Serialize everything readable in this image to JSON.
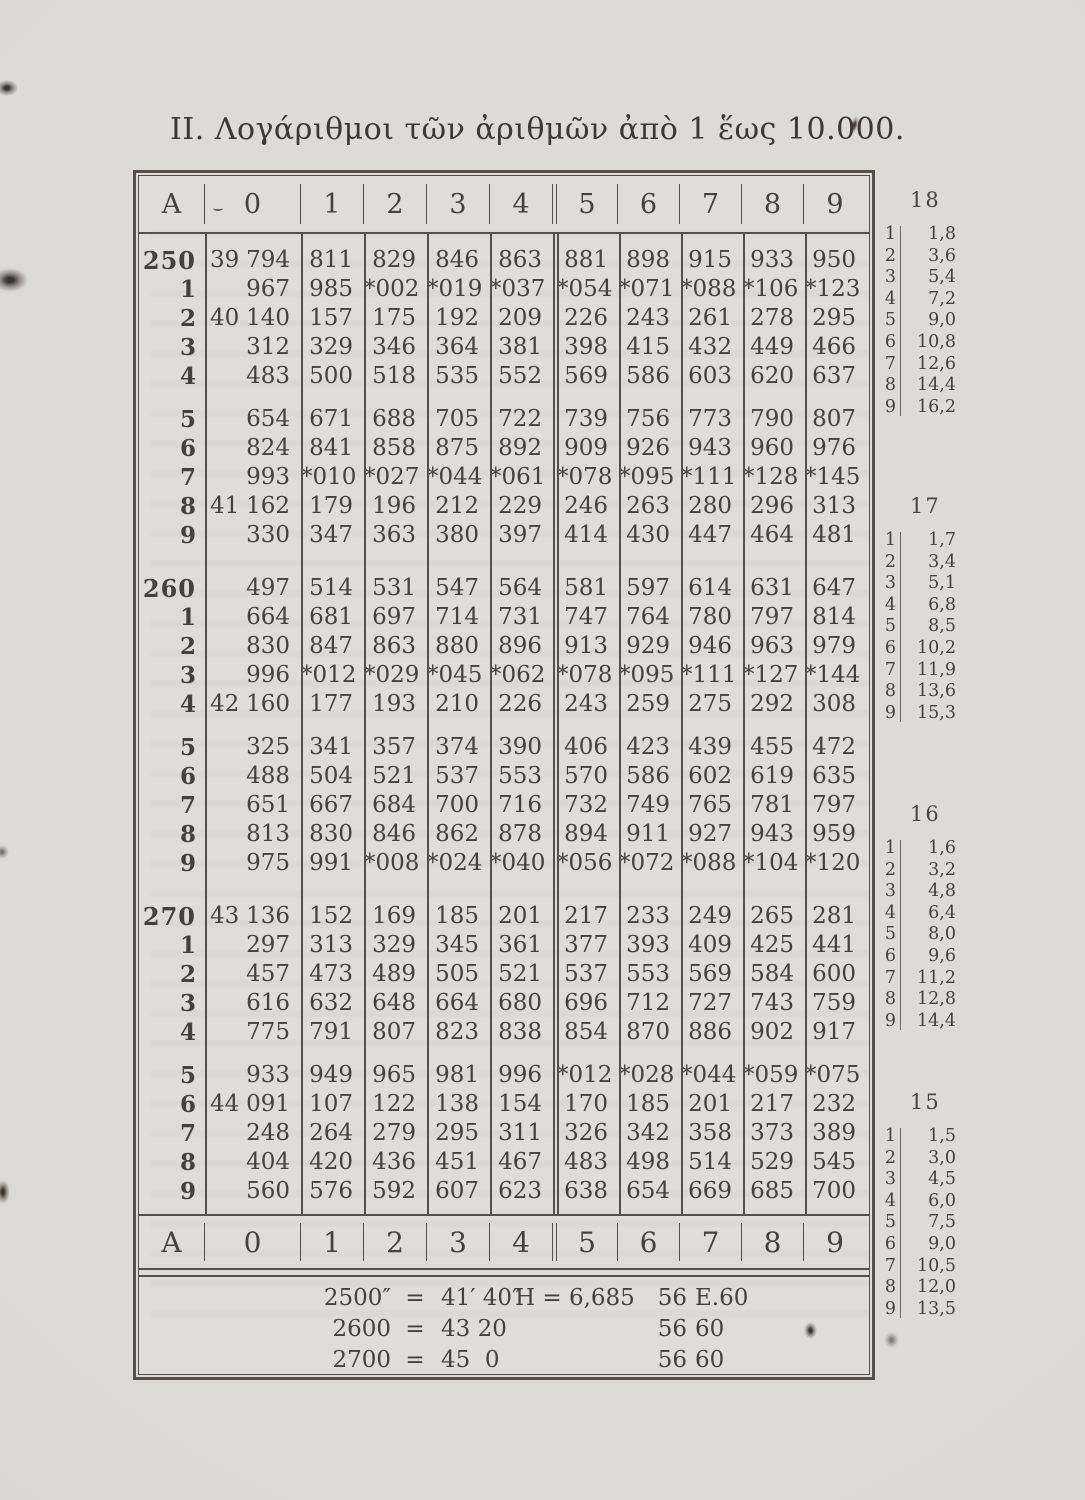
{
  "page": {
    "title": "II. Λογάριθμοι τῶν ἀριθμῶν ἀπὸ 1 ἕως 10.000."
  },
  "main_table": {
    "header": [
      "A",
      "0",
      "1",
      "2",
      "3",
      "4",
      "5",
      "6",
      "7",
      "8",
      "9"
    ],
    "footer_header": [
      "A",
      "0",
      "1",
      "2",
      "3",
      "4",
      "5",
      "6",
      "7",
      "8",
      "9"
    ],
    "blocks": [
      {
        "rows": [
          {
            "a": "250",
            "prefix": "39",
            "cells": [
              "794",
              "811",
              "829",
              "846",
              "863",
              "881",
              "898",
              "915",
              "933",
              "950"
            ]
          },
          {
            "a": "1",
            "prefix": "",
            "cells": [
              "967",
              "985",
              "*002",
              "*019",
              "*037",
              "*054",
              "*071",
              "*088",
              "*106",
              "*123"
            ]
          },
          {
            "a": "2",
            "prefix": "40",
            "cells": [
              "140",
              "157",
              "175",
              "192",
              "209",
              "226",
              "243",
              "261",
              "278",
              "295"
            ]
          },
          {
            "a": "3",
            "prefix": "",
            "cells": [
              "312",
              "329",
              "346",
              "364",
              "381",
              "398",
              "415",
              "432",
              "449",
              "466"
            ]
          },
          {
            "a": "4",
            "prefix": "",
            "cells": [
              "483",
              "500",
              "518",
              "535",
              "552",
              "569",
              "586",
              "603",
              "620",
              "637"
            ]
          },
          {
            "a": "5",
            "prefix": "",
            "cells": [
              "654",
              "671",
              "688",
              "705",
              "722",
              "739",
              "756",
              "773",
              "790",
              "807"
            ]
          },
          {
            "a": "6",
            "prefix": "",
            "cells": [
              "824",
              "841",
              "858",
              "875",
              "892",
              "909",
              "926",
              "943",
              "960",
              "976"
            ]
          },
          {
            "a": "7",
            "prefix": "",
            "cells": [
              "993",
              "*010",
              "*027",
              "*044",
              "*061",
              "*078",
              "*095",
              "*111",
              "*128",
              "*145"
            ]
          },
          {
            "a": "8",
            "prefix": "41",
            "cells": [
              "162",
              "179",
              "196",
              "212",
              "229",
              "246",
              "263",
              "280",
              "296",
              "313"
            ]
          },
          {
            "a": "9",
            "prefix": "",
            "cells": [
              "330",
              "347",
              "363",
              "380",
              "397",
              "414",
              "430",
              "447",
              "464",
              "481"
            ]
          }
        ]
      },
      {
        "rows": [
          {
            "a": "260",
            "prefix": "",
            "cells": [
              "497",
              "514",
              "531",
              "547",
              "564",
              "581",
              "597",
              "614",
              "631",
              "647"
            ]
          },
          {
            "a": "1",
            "prefix": "",
            "cells": [
              "664",
              "681",
              "697",
              "714",
              "731",
              "747",
              "764",
              "780",
              "797",
              "814"
            ]
          },
          {
            "a": "2",
            "prefix": "",
            "cells": [
              "830",
              "847",
              "863",
              "880",
              "896",
              "913",
              "929",
              "946",
              "963",
              "979"
            ]
          },
          {
            "a": "3",
            "prefix": "",
            "cells": [
              "996",
              "*012",
              "*029",
              "*045",
              "*062",
              "*078",
              "*095",
              "*111",
              "*127",
              "*144"
            ]
          },
          {
            "a": "4",
            "prefix": "42",
            "cells": [
              "160",
              "177",
              "193",
              "210",
              "226",
              "243",
              "259",
              "275",
              "292",
              "308"
            ]
          },
          {
            "a": "5",
            "prefix": "",
            "cells": [
              "325",
              "341",
              "357",
              "374",
              "390",
              "406",
              "423",
              "439",
              "455",
              "472"
            ]
          },
          {
            "a": "6",
            "prefix": "",
            "cells": [
              "488",
              "504",
              "521",
              "537",
              "553",
              "570",
              "586",
              "602",
              "619",
              "635"
            ]
          },
          {
            "a": "7",
            "prefix": "",
            "cells": [
              "651",
              "667",
              "684",
              "700",
              "716",
              "732",
              "749",
              "765",
              "781",
              "797"
            ]
          },
          {
            "a": "8",
            "prefix": "",
            "cells": [
              "813",
              "830",
              "846",
              "862",
              "878",
              "894",
              "911",
              "927",
              "943",
              "959"
            ]
          },
          {
            "a": "9",
            "prefix": "",
            "cells": [
              "975",
              "991",
              "*008",
              "*024",
              "*040",
              "*056",
              "*072",
              "*088",
              "*104",
              "*120"
            ]
          }
        ]
      },
      {
        "rows": [
          {
            "a": "270",
            "prefix": "43",
            "cells": [
              "136",
              "152",
              "169",
              "185",
              "201",
              "217",
              "233",
              "249",
              "265",
              "281"
            ]
          },
          {
            "a": "1",
            "prefix": "",
            "cells": [
              "297",
              "313",
              "329",
              "345",
              "361",
              "377",
              "393",
              "409",
              "425",
              "441"
            ]
          },
          {
            "a": "2",
            "prefix": "",
            "cells": [
              "457",
              "473",
              "489",
              "505",
              "521",
              "537",
              "553",
              "569",
              "584",
              "600"
            ]
          },
          {
            "a": "3",
            "prefix": "",
            "cells": [
              "616",
              "632",
              "648",
              "664",
              "680",
              "696",
              "712",
              "727",
              "743",
              "759"
            ]
          },
          {
            "a": "4",
            "prefix": "",
            "cells": [
              "775",
              "791",
              "807",
              "823",
              "838",
              "854",
              "870",
              "886",
              "902",
              "917"
            ]
          },
          {
            "a": "5",
            "prefix": "",
            "cells": [
              "933",
              "949",
              "965",
              "981",
              "996",
              "*012",
              "*028",
              "*044",
              "*059",
              "*075"
            ]
          },
          {
            "a": "6",
            "prefix": "44",
            "cells": [
              "091",
              "107",
              "122",
              "138",
              "154",
              "170",
              "185",
              "201",
              "217",
              "232"
            ]
          },
          {
            "a": "7",
            "prefix": "",
            "cells": [
              "248",
              "264",
              "279",
              "295",
              "311",
              "326",
              "342",
              "358",
              "373",
              "389"
            ]
          },
          {
            "a": "8",
            "prefix": "",
            "cells": [
              "404",
              "420",
              "436",
              "451",
              "467",
              "483",
              "498",
              "514",
              "529",
              "545"
            ]
          },
          {
            "a": "9",
            "prefix": "",
            "cells": [
              "560",
              "576",
              "592",
              "607",
              "623",
              "638",
              "654",
              "669",
              "685",
              "700"
            ]
          }
        ]
      }
    ]
  },
  "notes": {
    "conversions": [
      {
        "value": "2500″",
        "eq": "=",
        "result": "41′ 40″"
      },
      {
        "value": "2600",
        "eq": "=",
        "result": "43 20"
      },
      {
        "value": "2700",
        "eq": "=",
        "result": "45  0"
      }
    ],
    "height_column": [
      {
        "label": "H = 6,685",
        "v1": "56",
        "v2": "E.60"
      },
      {
        "label": "",
        "v1": "56",
        "v2": "60"
      },
      {
        "label": "",
        "v1": "56",
        "v2": "60"
      }
    ]
  },
  "proportional_parts": [
    {
      "difference": "18",
      "rows": [
        {
          "n": "1",
          "v": "1,8"
        },
        {
          "n": "2",
          "v": "3,6"
        },
        {
          "n": "3",
          "v": "5,4"
        },
        {
          "n": "4",
          "v": "7,2"
        },
        {
          "n": "5",
          "v": "9,0"
        },
        {
          "n": "6",
          "v": "10,8"
        },
        {
          "n": "7",
          "v": "12,6"
        },
        {
          "n": "8",
          "v": "14,4"
        },
        {
          "n": "9",
          "v": "16,2"
        }
      ]
    },
    {
      "difference": "17",
      "rows": [
        {
          "n": "1",
          "v": "1,7"
        },
        {
          "n": "2",
          "v": "3,4"
        },
        {
          "n": "3",
          "v": "5,1"
        },
        {
          "n": "4",
          "v": "6,8"
        },
        {
          "n": "5",
          "v": "8,5"
        },
        {
          "n": "6",
          "v": "10,2"
        },
        {
          "n": "7",
          "v": "11,9"
        },
        {
          "n": "8",
          "v": "13,6"
        },
        {
          "n": "9",
          "v": "15,3"
        }
      ]
    },
    {
      "difference": "16",
      "rows": [
        {
          "n": "1",
          "v": "1,6"
        },
        {
          "n": "2",
          "v": "3,2"
        },
        {
          "n": "3",
          "v": "4,8"
        },
        {
          "n": "4",
          "v": "6,4"
        },
        {
          "n": "5",
          "v": "8,0"
        },
        {
          "n": "6",
          "v": "9,6"
        },
        {
          "n": "7",
          "v": "11,2"
        },
        {
          "n": "8",
          "v": "12,8"
        },
        {
          "n": "9",
          "v": "14,4"
        }
      ]
    },
    {
      "difference": "15",
      "rows": [
        {
          "n": "1",
          "v": "1,5"
        },
        {
          "n": "2",
          "v": "3,0"
        },
        {
          "n": "3",
          "v": "4,5"
        },
        {
          "n": "4",
          "v": "6,0"
        },
        {
          "n": "5",
          "v": "7,5"
        },
        {
          "n": "6",
          "v": "9,0"
        },
        {
          "n": "7",
          "v": "10,5"
        },
        {
          "n": "8",
          "v": "12,0"
        },
        {
          "n": "9",
          "v": "13,5"
        }
      ]
    }
  ]
}
